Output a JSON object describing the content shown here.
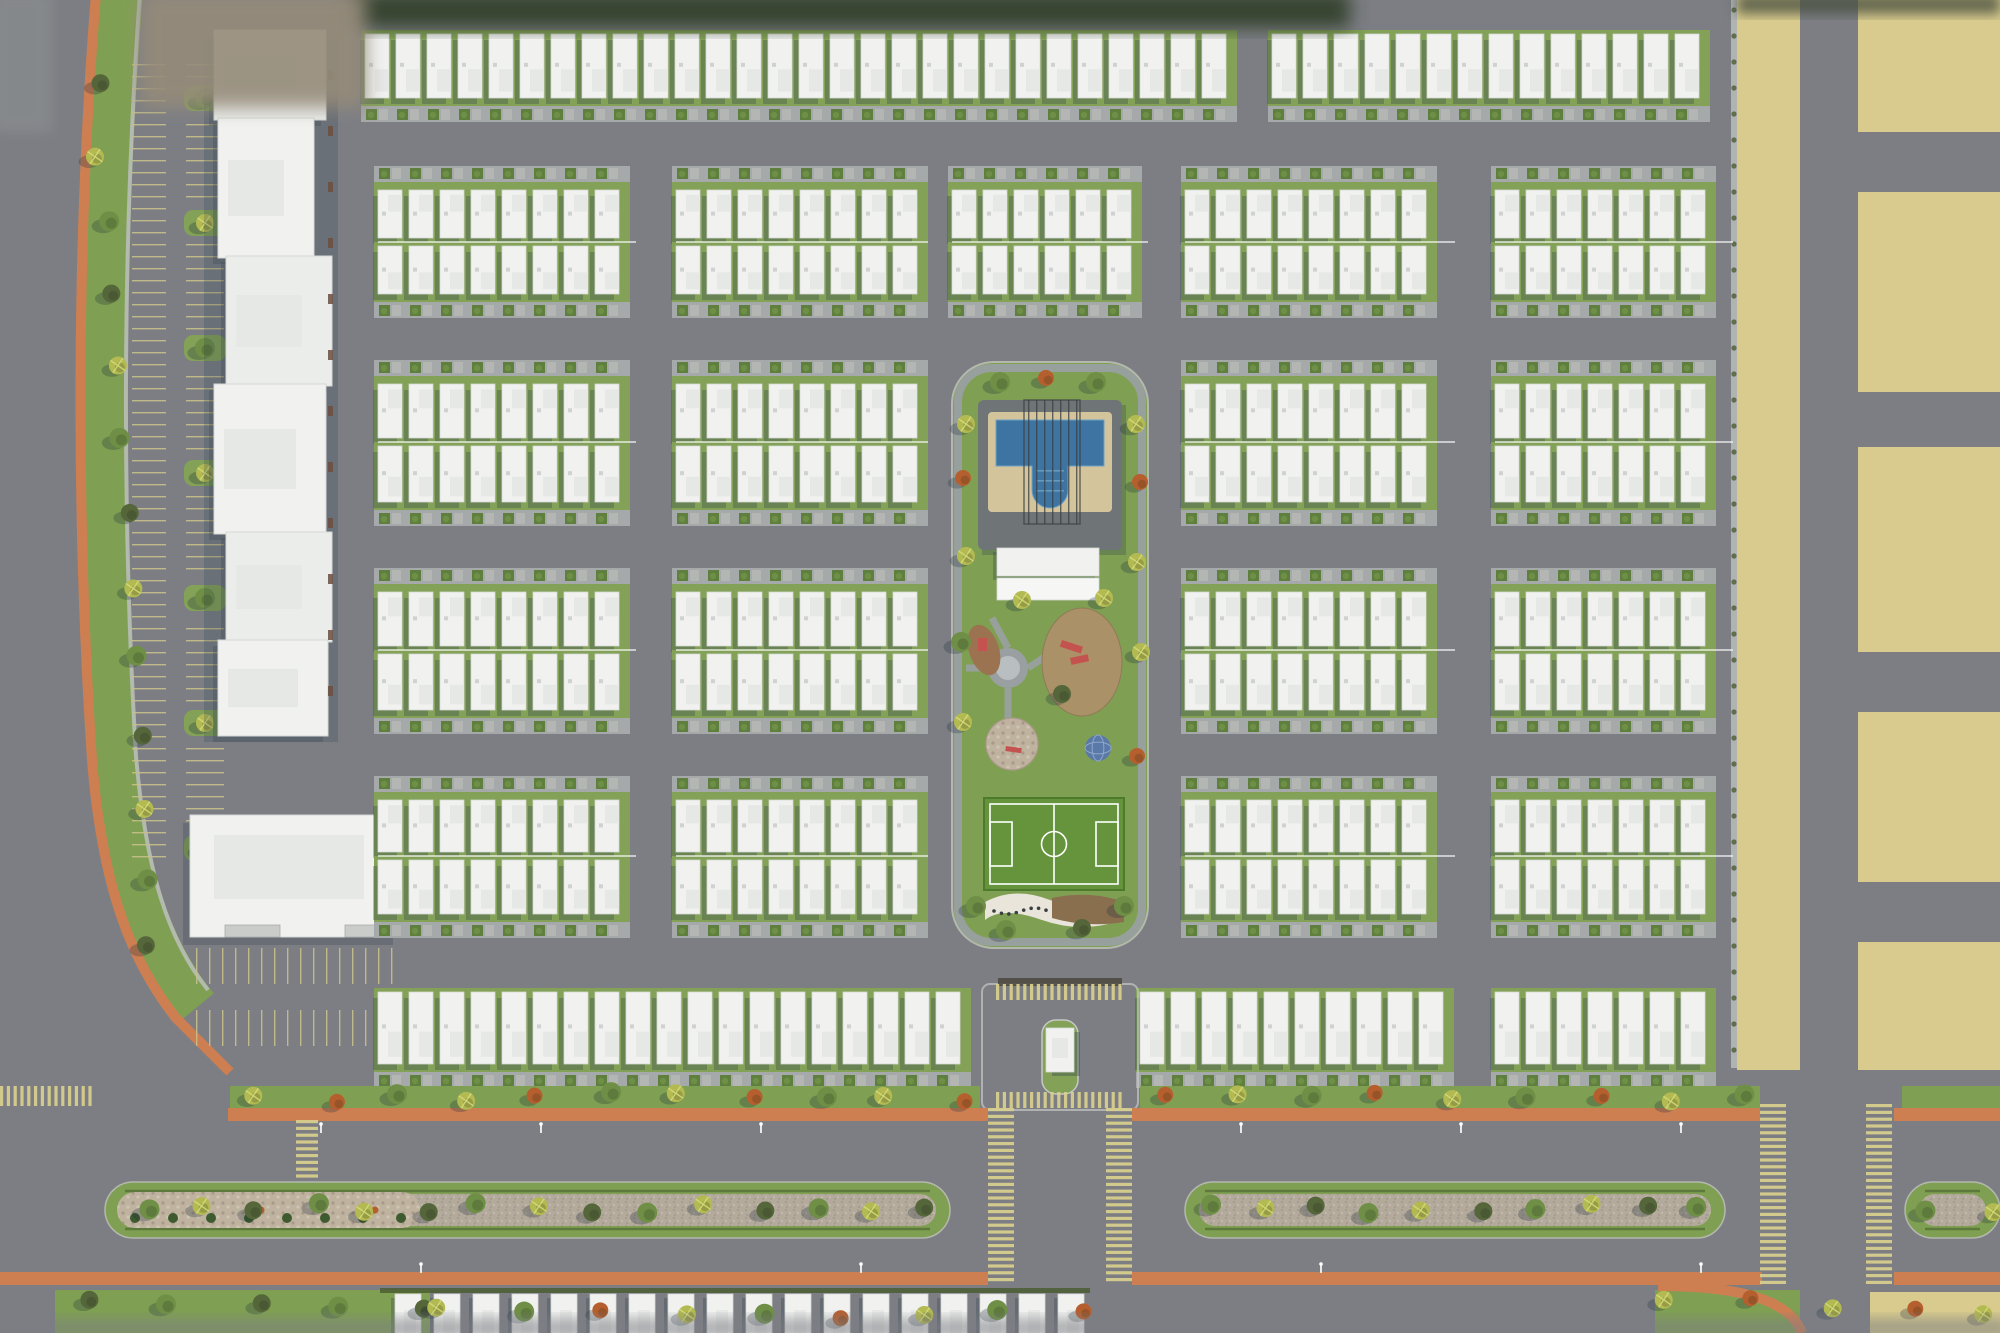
{
  "scene": {
    "type": "aerial-site-plan-render",
    "subject": "residential community master plan, top-down 3D render",
    "visible_text": []
  },
  "canvas": {
    "w": 2000,
    "h": 1333
  },
  "palette": {
    "road": "#7c7e84",
    "blockPave": "#a6a9a9",
    "sidewalk": "#b9bcb8",
    "roofA": "#f1f2f0",
    "roofEdge": "#d5d8d6",
    "roofStep": "#e6e8e6",
    "shadow": "#2f3e4d",
    "grass": "#7fa052",
    "grassDark": "#5f7f3e",
    "grassYard": "#83a157",
    "sand": "#d8cb8d",
    "orange": "#cd7f52",
    "pool": "#3e74a1",
    "poolLight": "#6fa2c5",
    "deck": "#d3c49b",
    "padSlate": "#6f7477",
    "field": "#65943c",
    "fieldLine": "#ffffff",
    "gravel": "#b3aa9b",
    "mosaic": "#bfb3a0",
    "soil": "#9b7350",
    "playTan": "#ab9168",
    "red": "#c4524e",
    "domeBlue": "#5a79a8",
    "hedge": "#5d7a3c",
    "olive": "#55663a",
    "green": "#6e8f45",
    "palm": "#b4ba52",
    "rust": "#b65f2e",
    "curb": "#c6c9c5",
    "stripeYellow": "#d9cf8e",
    "parkTick": "#c8c08a",
    "dark": "#3a3f42",
    "doorBrown": "#6b4f3e",
    "blurTan": "#958b79",
    "blurDark": "#333f2c"
  },
  "house_rows": [
    {
      "name": "top-row",
      "y": 30,
      "d": 92,
      "dir": "down",
      "pitch": 31,
      "spans": [
        [
          365,
          1256
        ],
        [
          1272,
          1729
        ]
      ]
    },
    {
      "name": "block1-north",
      "y": 166,
      "d": 76,
      "dir": "up",
      "pitch": 31,
      "spans": [
        [
          378,
          636
        ],
        [
          676,
          928
        ],
        [
          952,
          1148
        ],
        [
          1185,
          1455
        ],
        [
          1495,
          1733
        ]
      ]
    },
    {
      "name": "block1-south",
      "y": 242,
      "d": 76,
      "dir": "down",
      "pitch": 31,
      "spans": [
        [
          378,
          636
        ],
        [
          676,
          928
        ],
        [
          952,
          1148
        ],
        [
          1185,
          1455
        ],
        [
          1495,
          1733
        ]
      ]
    },
    {
      "name": "block2-north",
      "y": 360,
      "d": 82,
      "dir": "up",
      "pitch": 31,
      "spans": [
        [
          378,
          636
        ],
        [
          676,
          928
        ],
        [
          1185,
          1455
        ],
        [
          1495,
          1733
        ]
      ]
    },
    {
      "name": "block2-south",
      "y": 442,
      "d": 84,
      "dir": "down",
      "pitch": 31,
      "spans": [
        [
          378,
          636
        ],
        [
          676,
          928
        ],
        [
          1185,
          1455
        ],
        [
          1495,
          1733
        ]
      ]
    },
    {
      "name": "block3-north",
      "y": 568,
      "d": 82,
      "dir": "up",
      "pitch": 31,
      "spans": [
        [
          378,
          636
        ],
        [
          676,
          928
        ],
        [
          1185,
          1455
        ],
        [
          1495,
          1733
        ]
      ]
    },
    {
      "name": "block3-south",
      "y": 650,
      "d": 84,
      "dir": "down",
      "pitch": 31,
      "spans": [
        [
          378,
          636
        ],
        [
          676,
          928
        ],
        [
          1185,
          1455
        ],
        [
          1495,
          1733
        ]
      ]
    },
    {
      "name": "block4-north",
      "y": 776,
      "d": 80,
      "dir": "up",
      "pitch": 31,
      "spans": [
        [
          378,
          636
        ],
        [
          676,
          928
        ],
        [
          1185,
          1455
        ],
        [
          1495,
          1733
        ]
      ]
    },
    {
      "name": "block4-south",
      "y": 856,
      "d": 82,
      "dir": "down",
      "pitch": 31,
      "spans": [
        [
          378,
          636
        ],
        [
          676,
          928
        ],
        [
          1185,
          1455
        ],
        [
          1495,
          1733
        ]
      ]
    },
    {
      "name": "south-row",
      "y": 988,
      "d": 100,
      "dir": "down",
      "pitch": 31,
      "spans": [
        [
          378,
          980
        ],
        [
          1140,
          1455
        ],
        [
          1495,
          1733
        ]
      ]
    }
  ],
  "fences": [
    {
      "y": 242,
      "spans": [
        [
          378,
          636
        ],
        [
          676,
          928
        ],
        [
          952,
          1148
        ],
        [
          1185,
          1455
        ],
        [
          1495,
          1733
        ]
      ]
    },
    {
      "y": 442,
      "spans": [
        [
          378,
          636
        ],
        [
          676,
          928
        ],
        [
          1185,
          1455
        ],
        [
          1495,
          1733
        ]
      ]
    },
    {
      "y": 650,
      "spans": [
        [
          378,
          636
        ],
        [
          676,
          928
        ],
        [
          1185,
          1455
        ],
        [
          1495,
          1733
        ]
      ]
    },
    {
      "y": 856,
      "spans": [
        [
          378,
          636
        ],
        [
          676,
          928
        ],
        [
          1185,
          1455
        ],
        [
          1495,
          1733
        ]
      ]
    }
  ],
  "bottom_row": {
    "y": 1294,
    "x0": 395,
    "x1": 1085,
    "pitch": 39,
    "w": 26,
    "h": 40,
    "hedge": [
      380,
      1288,
      710,
      5
    ]
  },
  "commercial": {
    "shadow": [
      204,
      40,
      134,
      702
    ],
    "strip": [
      [
        214,
        30,
        112,
        90
      ],
      [
        218,
        118,
        96,
        140
      ],
      [
        226,
        256,
        106,
        130
      ],
      [
        214,
        384,
        112,
        150
      ],
      [
        226,
        532,
        106,
        110
      ],
      [
        218,
        640,
        110,
        96
      ]
    ],
    "anchor": [
      190,
      815,
      210,
      122
    ],
    "anchor_canopies": [
      [
        225,
        925,
        55,
        12
      ],
      [
        345,
        925,
        40,
        12
      ]
    ]
  },
  "parking": {
    "cols": [
      {
        "x": 132,
        "w": 34,
        "y0": 64,
        "y1": 858,
        "pitch": 12
      },
      {
        "x": 186,
        "w": 38,
        "y0": 64,
        "y1": 858,
        "pitch": 12
      }
    ],
    "islands_x": 184,
    "islands_y": [
      85,
      210,
      335,
      460,
      585,
      710,
      835
    ],
    "south": [
      {
        "x0": 196,
        "x1": 398,
        "y": 948,
        "h": 36,
        "pitch": 13
      },
      {
        "x0": 196,
        "x1": 398,
        "y": 1010,
        "h": 36,
        "pitch": 13
      }
    ]
  },
  "west": {
    "verge_path": "M120,-6 C100,240 100,520 114,758 C124,878 150,952 196,1008",
    "orange_path": "M96,-6 C76,240 76,520 92,760 C102,885 130,960 176,1018 L230,1072",
    "sidewalk_path": "M140,-6 C122,240 122,520 136,756 C146,872 168,940 208,990"
  },
  "park": {
    "rect": [
      952,
      362,
      196,
      586
    ],
    "ring": [
      958,
      368,
      184,
      574
    ],
    "pool": {
      "pad": [
        978,
        400,
        144,
        150
      ],
      "deck": [
        988,
        412,
        124,
        100
      ],
      "water": "M996,420 h108 v46 h-36 v24 a18,18 0 0 1 -36,0 v-24 h-36 z",
      "pergola": {
        "x0": 1028,
        "x1": 1076,
        "y0": 400,
        "y1": 524,
        "n": 7
      },
      "house": [
        997,
        548,
        102,
        28
      ],
      "house2": [
        997,
        578,
        102,
        22
      ]
    },
    "plaza": {
      "cx": 1008,
      "cy": 668,
      "r": 20
    },
    "paths": [
      [
        1008,
        648,
        992,
        618
      ],
      [
        1008,
        688,
        1008,
        728
      ],
      [
        1028,
        668,
        1052,
        652
      ],
      [
        988,
        668,
        966,
        668
      ]
    ],
    "soil_blob": {
      "cx": 984,
      "cy": 650,
      "rx": 15,
      "ry": 26,
      "rot": -18
    },
    "play_area": {
      "cx": 1082,
      "cy": 662,
      "rx": 40,
      "ry": 54
    },
    "mosaic_circle": {
      "cx": 1012,
      "cy": 744,
      "r": 26
    },
    "dome": {
      "cx": 1098,
      "cy": 748,
      "r": 13
    },
    "red_items": [
      [
        978,
        638,
        9,
        13,
        0
      ],
      [
        1062,
        640,
        22,
        7,
        18
      ],
      [
        1070,
        658,
        18,
        7,
        -12
      ],
      [
        1006,
        746,
        16,
        5,
        8
      ]
    ],
    "field": {
      "outer": [
        984,
        798,
        140,
        92
      ],
      "inner": [
        990,
        804,
        128,
        80
      ],
      "mid_x": 1054,
      "circle_r": 12.5,
      "box_l": [
        990,
        822,
        22,
        44
      ],
      "box_r": [
        1096,
        822,
        22,
        44
      ]
    },
    "wave": "M985,902 Q1015,886 1050,900 T1120,900 L1122,920 Q1082,934 1042,920 T985,920 Z",
    "bed": "M1052,898 Q1090,890 1124,902 L1124,922 Q1086,928 1052,918 Z",
    "dots": {
      "x0": 994,
      "x1": 1046,
      "y": 911,
      "n": 8
    },
    "trees": [
      [
        1000,
        382,
        "green"
      ],
      [
        1046,
        378,
        "rust"
      ],
      [
        1096,
        382,
        "green"
      ],
      [
        966,
        424,
        "palm"
      ],
      [
        963,
        478,
        "rust"
      ],
      [
        966,
        556,
        "palm"
      ],
      [
        961,
        642,
        "green"
      ],
      [
        963,
        722,
        "palm"
      ],
      [
        976,
        906,
        "green"
      ],
      [
        1136,
        424,
        "palm"
      ],
      [
        1140,
        482,
        "rust"
      ],
      [
        1137,
        562,
        "palm"
      ],
      [
        1141,
        652,
        "palm"
      ],
      [
        1137,
        756,
        "rust"
      ],
      [
        1124,
        906,
        "green"
      ],
      [
        1006,
        930,
        "green"
      ],
      [
        1082,
        928,
        "olive"
      ],
      [
        1022,
        600,
        "palm"
      ],
      [
        1104,
        598,
        "palm"
      ],
      [
        1062,
        694,
        "olive"
      ]
    ]
  },
  "entrance": {
    "plaza": [
      982,
      984,
      156,
      126
    ],
    "pergola": [
      998,
      978,
      124,
      8
    ],
    "island": [
      1042,
      1020,
      36,
      74
    ],
    "gatehouse": [
      1046,
      1028,
      28,
      44
    ]
  },
  "boulevard": {
    "n_verge": {
      "y": 1086,
      "h": 22,
      "segs": [
        [
          230,
          980
        ],
        [
          1140,
          1760
        ],
        [
          1902,
          2000
        ]
      ]
    },
    "n_orange": {
      "y": 1108,
      "h": 13,
      "segs": [
        [
          228,
          988
        ],
        [
          1132,
          1760
        ],
        [
          1894,
          2000
        ]
      ]
    },
    "s_orange": {
      "y": 1272,
      "h": 13,
      "segs": [
        [
          0,
          988
        ],
        [
          1132,
          1762
        ],
        [
          1894,
          2000
        ]
      ]
    },
    "median": {
      "y": 1182,
      "h": 56,
      "segs": [
        [
          105,
          950
        ],
        [
          1185,
          1725
        ],
        [
          1905,
          2000
        ]
      ],
      "mosaic_limit": 420
    },
    "s_verge": [
      [
        55,
        1290,
        375,
        43
      ],
      [
        1655,
        1290,
        145,
        43
      ]
    ],
    "s_orange_curve": "M1658,1286 C1740,1286 1790,1300 1802,1333",
    "lamps": [
      [
        320,
        1124
      ],
      [
        540,
        1124
      ],
      [
        760,
        1124
      ],
      [
        1240,
        1124
      ],
      [
        1460,
        1124
      ],
      [
        1680,
        1124
      ],
      [
        420,
        1264
      ],
      [
        860,
        1264
      ],
      [
        1320,
        1264
      ],
      [
        1700,
        1264
      ]
    ]
  },
  "yellow_zone": {
    "blocks": [
      [
        1737,
        0,
        63,
        1070
      ],
      [
        1858,
        0,
        142,
        132
      ],
      [
        1858,
        192,
        142,
        200
      ],
      [
        1858,
        447,
        142,
        205
      ],
      [
        1858,
        712,
        142,
        170
      ],
      [
        1858,
        942,
        142,
        128
      ],
      [
        1870,
        1292,
        130,
        41
      ]
    ],
    "sidewalk": [
      1731,
      0,
      6,
      1068
    ]
  },
  "crosswalks": [
    {
      "x": 988,
      "y": 1108,
      "w": 26,
      "h": 178,
      "dir": "v"
    },
    {
      "x": 1106,
      "y": 1108,
      "w": 26,
      "h": 178,
      "dir": "v"
    },
    {
      "x": 1760,
      "y": 1104,
      "w": 26,
      "h": 186,
      "dir": "v"
    },
    {
      "x": 1866,
      "y": 1104,
      "w": 26,
      "h": 186,
      "dir": "v"
    },
    {
      "x": 996,
      "y": 984,
      "w": 128,
      "h": 16,
      "dir": "h"
    },
    {
      "x": 996,
      "y": 1092,
      "w": 128,
      "h": 16,
      "dir": "h"
    },
    {
      "x": 0,
      "y": 1086,
      "w": 92,
      "h": 20,
      "dir": "h"
    },
    {
      "x": 296,
      "y": 1120,
      "w": 22,
      "h": 64,
      "dir": "v"
    }
  ],
  "tree_belts": [
    {
      "p": [
        [
          96,
          80
        ],
        [
          150,
          950
        ]
      ],
      "n": 13,
      "kinds": [
        "olive",
        "palm",
        "green"
      ]
    },
    {
      "p": [
        [
          145,
          1208
        ],
        [
          930,
          1208
        ]
      ],
      "n": 15,
      "kinds": [
        "green",
        "palm",
        "olive"
      ]
    },
    {
      "p": [
        [
          1205,
          1208
        ],
        [
          1700,
          1208
        ]
      ],
      "n": 10,
      "kinds": [
        "green",
        "palm",
        "olive"
      ]
    },
    {
      "p": [
        [
          1925,
          1208
        ],
        [
          1990,
          1208
        ]
      ],
      "n": 2,
      "kinds": [
        "green",
        "palm"
      ]
    },
    {
      "p": [
        [
          260,
          1097
        ],
        [
          960,
          1097
        ]
      ],
      "n": 11,
      "kinds": [
        "palm",
        "rust",
        "green"
      ]
    },
    {
      "p": [
        [
          1160,
          1097
        ],
        [
          1745,
          1097
        ]
      ],
      "n": 9,
      "kinds": [
        "rust",
        "palm",
        "green"
      ]
    },
    {
      "p": [
        [
          90,
          1300
        ],
        [
          420,
          1306
        ]
      ],
      "n": 5,
      "kinds": [
        "olive",
        "green"
      ]
    },
    {
      "p": [
        [
          1670,
          1300
        ],
        [
          1990,
          1310
        ]
      ],
      "n": 5,
      "kinds": [
        "palm",
        "rust"
      ]
    },
    {
      "p": [
        [
          440,
          1312
        ],
        [
          1080,
          1314
        ]
      ],
      "n": 9,
      "kinds": [
        "palm",
        "green",
        "rust"
      ]
    }
  ],
  "edge_blur": [
    {
      "r": [
        350,
        -8,
        1000,
        36
      ],
      "fill": "#333f2c",
      "blur": 9,
      "op": 0.95
    },
    {
      "r": [
        140,
        -8,
        226,
        116
      ],
      "fill": "#958b79",
      "blur": 9,
      "op": 0.9
    },
    {
      "r": [
        1737,
        -6,
        263,
        20
      ],
      "fill": "#49503f",
      "blur": 6,
      "op": 0.8
    },
    {
      "r": [
        -8,
        -8,
        60,
        140
      ],
      "fill": "#8a8d8f",
      "blur": 6,
      "op": 0.7
    },
    {
      "r": [
        -8,
        1318,
        2016,
        20
      ],
      "fill": "#7c7e84",
      "blur": 6,
      "op": 0.55
    }
  ]
}
